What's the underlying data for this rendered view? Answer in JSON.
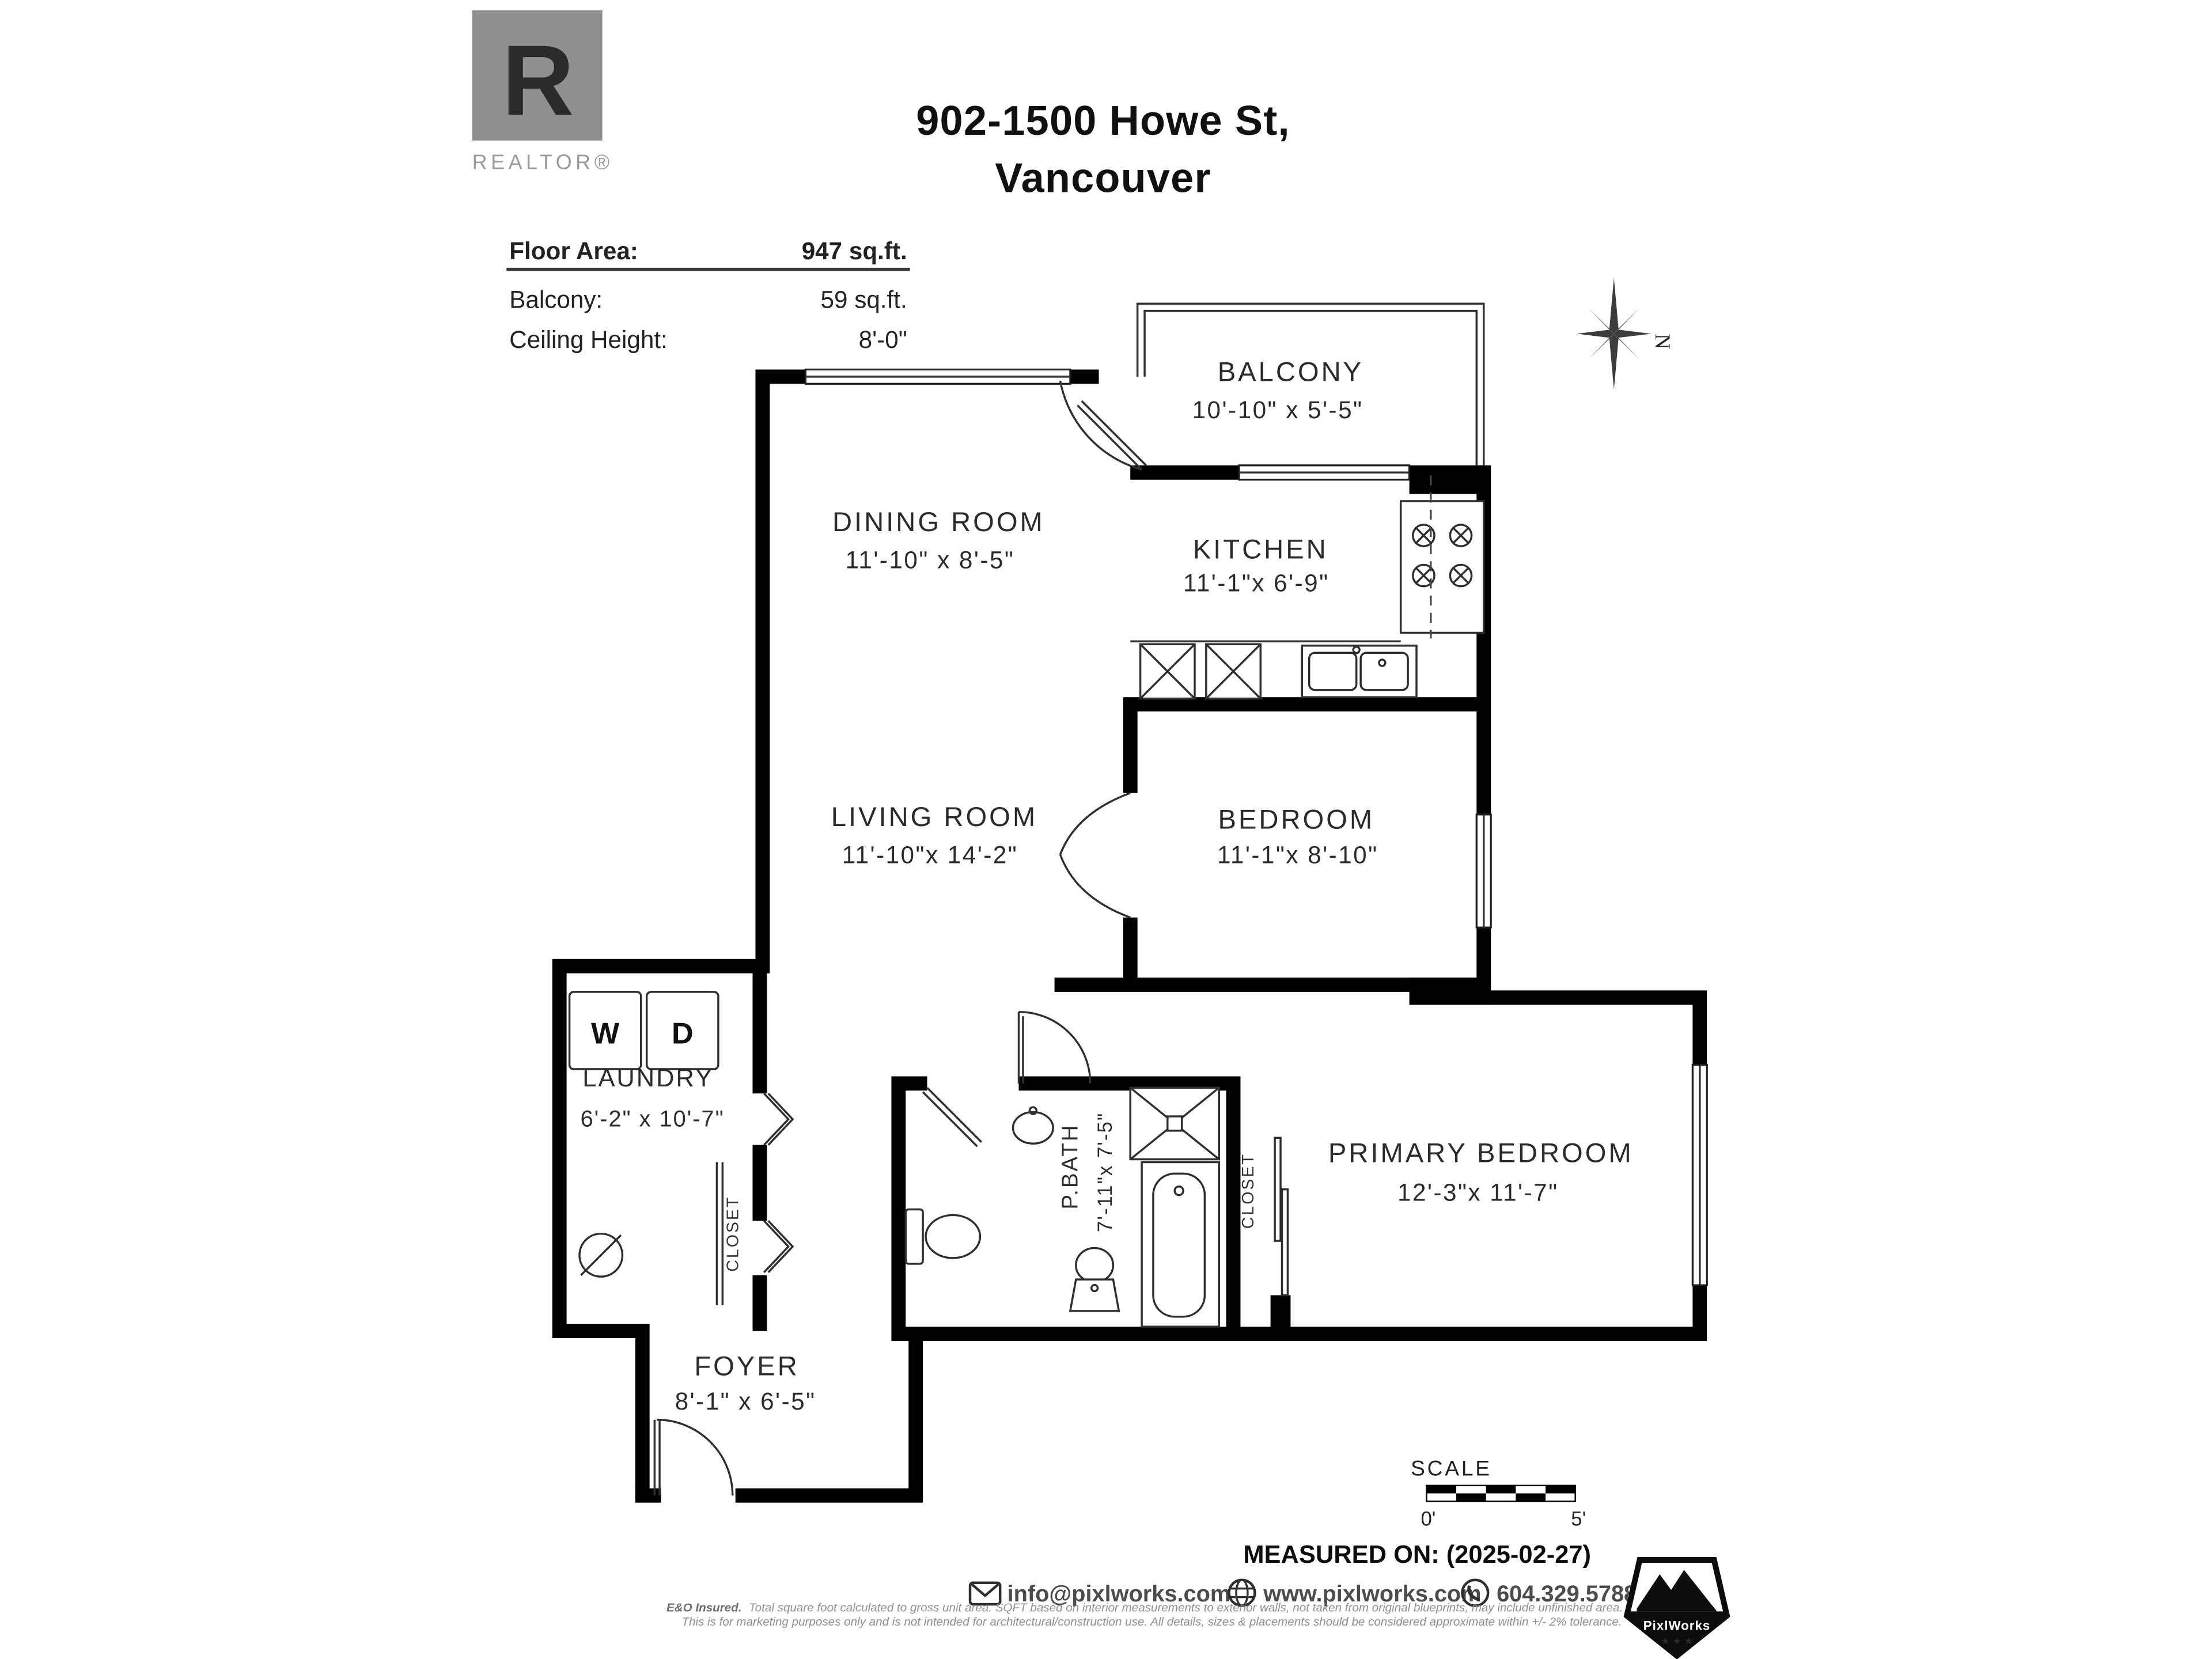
{
  "title": {
    "line1": "902-1500 Howe St,",
    "line2": "Vancouver"
  },
  "logo": {
    "letter": "R",
    "wordmark": "REALTOR®"
  },
  "info": {
    "rows": [
      {
        "label": "Floor Area:",
        "value": "947 sq.ft."
      },
      {
        "label": "Balcony:",
        "value": "59 sq.ft."
      },
      {
        "label": "Ceiling Height:",
        "value": "8'-0\""
      }
    ]
  },
  "compass": {
    "north": "N"
  },
  "rooms": {
    "balcony": {
      "name": "BALCONY",
      "dims": "10'-10\" x 5'-5\""
    },
    "dining": {
      "name": "DINING ROOM",
      "dims": "11'-10\" x 8'-5\""
    },
    "kitchen": {
      "name": "KITCHEN",
      "dims": "11'-1\"x 6'-9\""
    },
    "living": {
      "name": "LIVING ROOM",
      "dims": "11'-10\"x 14'-2\""
    },
    "bedroom": {
      "name": "BEDROOM",
      "dims": "11'-1\"x 8'-10\""
    },
    "laundry": {
      "name": "LAUNDRY",
      "dims": "6'-2\" x 10'-7\""
    },
    "pbath": {
      "name": "P.BATH",
      "dims": "7'-11\"x 7'-5\""
    },
    "primary": {
      "name": "PRIMARY BEDROOM",
      "dims": "12'-3\"x 11'-7\""
    },
    "foyer": {
      "name": "FOYER",
      "dims": "8'-1\" x 6'-5\""
    }
  },
  "fixtures": {
    "washer": "W",
    "dryer": "D",
    "closet_laundry": "CLOSET",
    "closet_primary": "CLOSET"
  },
  "footer": {
    "scale_label": "SCALE",
    "scale_start": "0'",
    "scale_end": "5'",
    "measured_on": "MEASURED ON: (2025-02-27)",
    "email": "info@pixlworks.com",
    "website": "www.pixlworks.com",
    "phone": "604.329.5788",
    "brand": "PixlWorks",
    "disclaimer_bold": "E&O Insured.",
    "disclaimer_line1": "Total square foot calculated to gross unit area. SQFT based on interior measurements to exterior walls, not taken from original blueprints, may include unfinished area.",
    "disclaimer_line2": "This is for marketing purposes only and is not intended for architectural/construction use.  All details, sizes & placements should be considered approximate within +/- 2%  tolerance."
  }
}
